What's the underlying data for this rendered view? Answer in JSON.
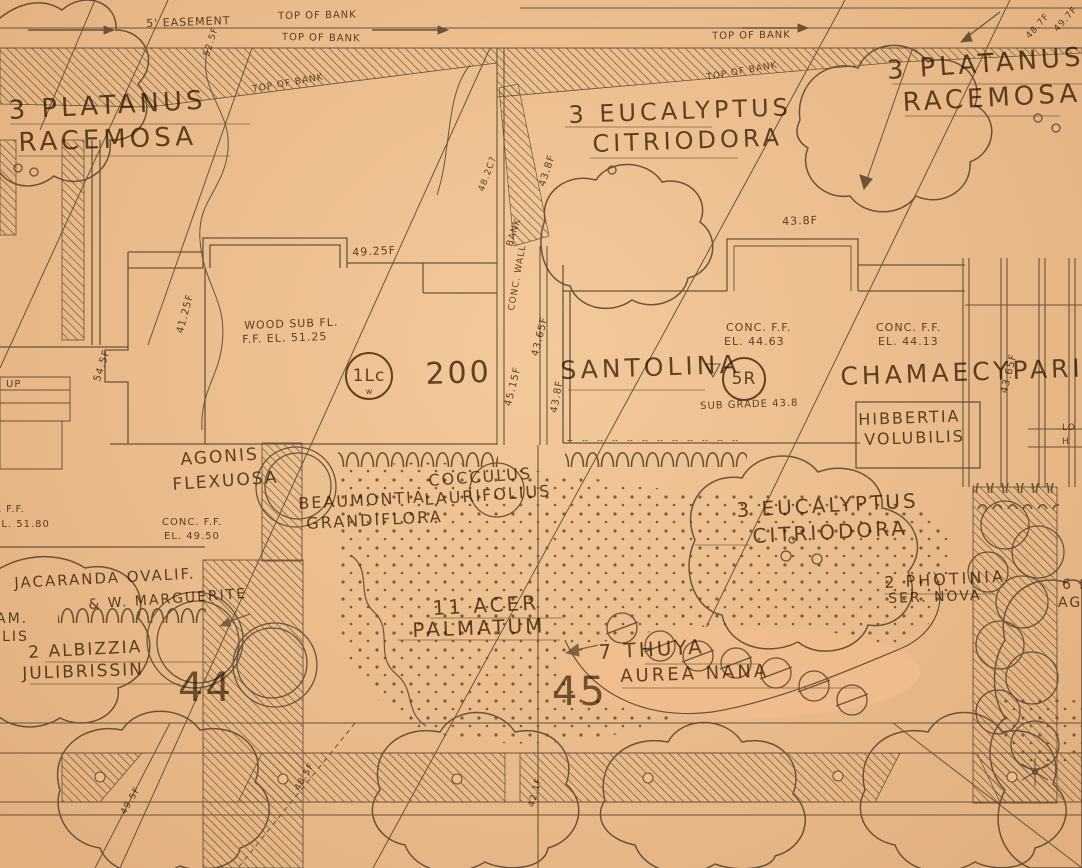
{
  "meta": {
    "sheet_type": "hand-drawn landscape planting plan (scanned blueprint on tan paper)"
  },
  "colors": {
    "paper": "#f0be8e",
    "ink": "#5a4528"
  },
  "bank": {
    "easement": "5' EASEMENT",
    "top_of_bank_a": "TOP OF BANK",
    "top_of_bank_b": "TOP OF BANK",
    "top_of_bank_c": "TOP OF BANK",
    "top_of_bank_d": "TOP OF BANK",
    "top_of_bank_e": "TOP OF BANK",
    "bank": "BANK",
    "conc_wall": "CONC. WALL"
  },
  "parcels": {
    "p44": "44",
    "p45": "45",
    "house_number": "200"
  },
  "refs": {
    "r1": "1Lc",
    "r1_sub": "w",
    "r2": "5R"
  },
  "buildings": {
    "up": "UP",
    "left": {
      "l1": "WOOD SUB FL.",
      "l2": "F.F. EL. 51.25"
    },
    "left_lower": {
      "l1": "CONC. F.F.",
      "l2": "EL. 49.50"
    },
    "left_edge": {
      "l1": "R F.F.",
      "l2": "EL. 51.80"
    },
    "mid": {
      "l1": "CONC. F.F.",
      "l2": "EL. 44.63",
      "sub": "SUB GRADE 43.8"
    },
    "right": {
      "l1": "CONC. F.F.",
      "l2": "EL. 44.13"
    }
  },
  "plants": {
    "platanus_left": {
      "l1": "3 PLATANUS",
      "l2": "RACEMOSA"
    },
    "platanus_right": {
      "l1": "3 PLATANUS",
      "l2": "RACEMOSA"
    },
    "eucalyptus_top": {
      "l1": "3 EUCALYPTUS",
      "l2": "CITRIODORA"
    },
    "eucalyptus_mid": {
      "l1": "3 EUCALYPTUS",
      "l2": "CITRIODORA"
    },
    "santolina": "SANTOLINA",
    "chamaecyparis": "CHAMAECYPARIS",
    "hibbertia": {
      "l1": "HIBBERTIA",
      "l2": "VOLUBILIS"
    },
    "agonis": {
      "l1": "AGONIS",
      "l2": "FLEXUOSA"
    },
    "beaumontia": {
      "l1": "BEAUMONTIA",
      "l2": "GRANDIFLORA"
    },
    "cocculus": {
      "l1": "COCCULUS",
      "l2": "LAURIFOLIUS"
    },
    "jacaranda": "JACARANDA OVALIF.",
    "marguerite": "& W. MARGUERITE",
    "albizzia": {
      "l1": "2 ALBIZZIA",
      "l2": "JULIBRISSIN"
    },
    "acer": {
      "l1": "11 ACER",
      "l2": "PALMATUM"
    },
    "thuya": {
      "l1": "7 THUYA",
      "l2": "AUREA NANA"
    },
    "photinia": {
      "l1": "2 PHOTINIA",
      "l2": "SER. NOVA"
    },
    "fragment_am": "AM.",
    "fragment_ilis": "ILIS",
    "fragment_6s": "6 S",
    "fragment_ag": "AG",
    "fragment_lo": "LO",
    "fragment_h": "H"
  },
  "elevations": {
    "e1": "49.25F",
    "e2": "41.25F",
    "e3": "54.5F",
    "e4": "43.8F",
    "e5": "48.2C?",
    "e6": "43.8F",
    "e7": "45.15F",
    "e8": "43.65F",
    "e9": "43.8F",
    "e10": "43.65F",
    "e11": "48.7F",
    "e12": "49.7F",
    "e13": "42.1F",
    "e14": "48.5F",
    "e15": "49.5F",
    "e16": "52.5F"
  }
}
